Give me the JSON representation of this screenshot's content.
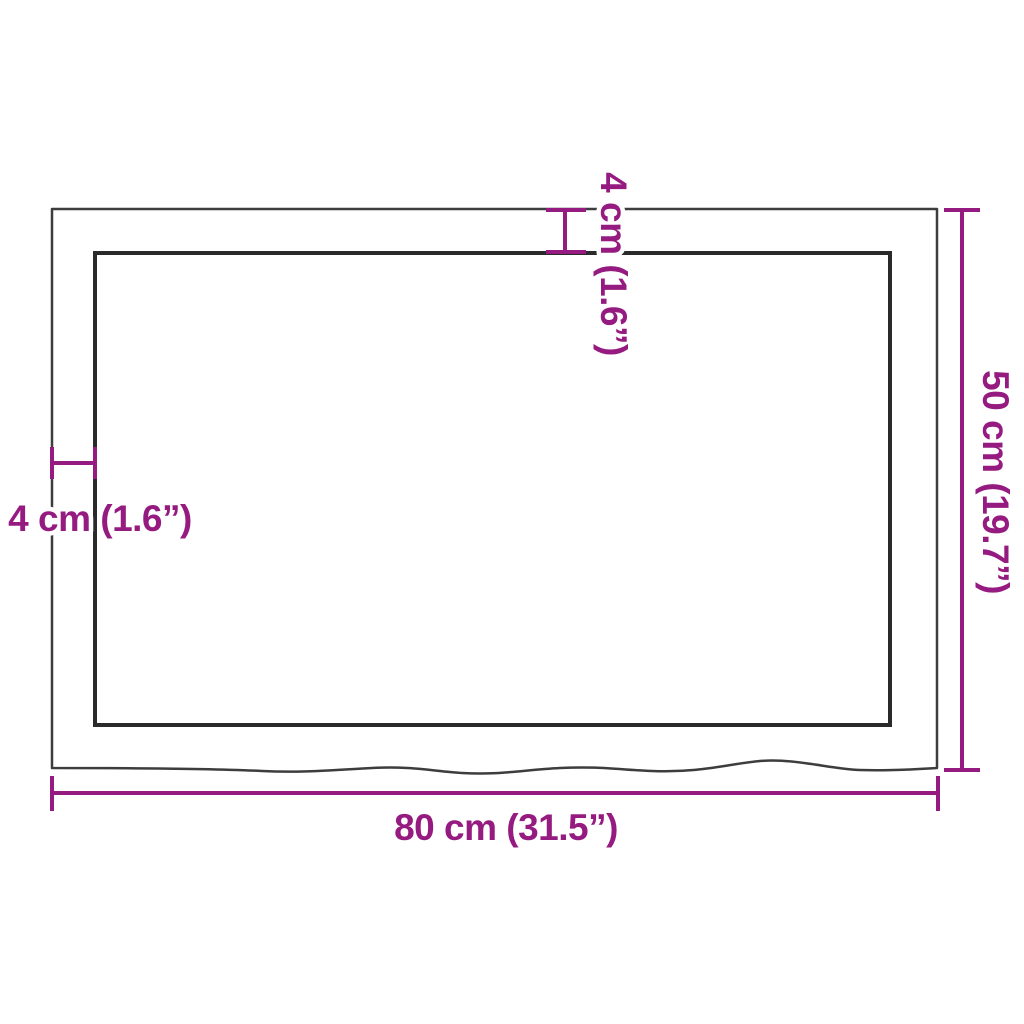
{
  "diagram": {
    "kind": "product-dimension-diagram",
    "labels": {
      "width": "80 cm (31.5”)",
      "height": "50 cm (19.7”)",
      "thickness_top": "4 cm (1.6”)",
      "thickness_left": "4 cm (1.6”)"
    },
    "colors": {
      "dimension_accent": "#951b81",
      "board_outer_stroke": "#3d3d3d",
      "board_inner_stroke": "#2a2a2a",
      "background": "#ffffff"
    }
  }
}
